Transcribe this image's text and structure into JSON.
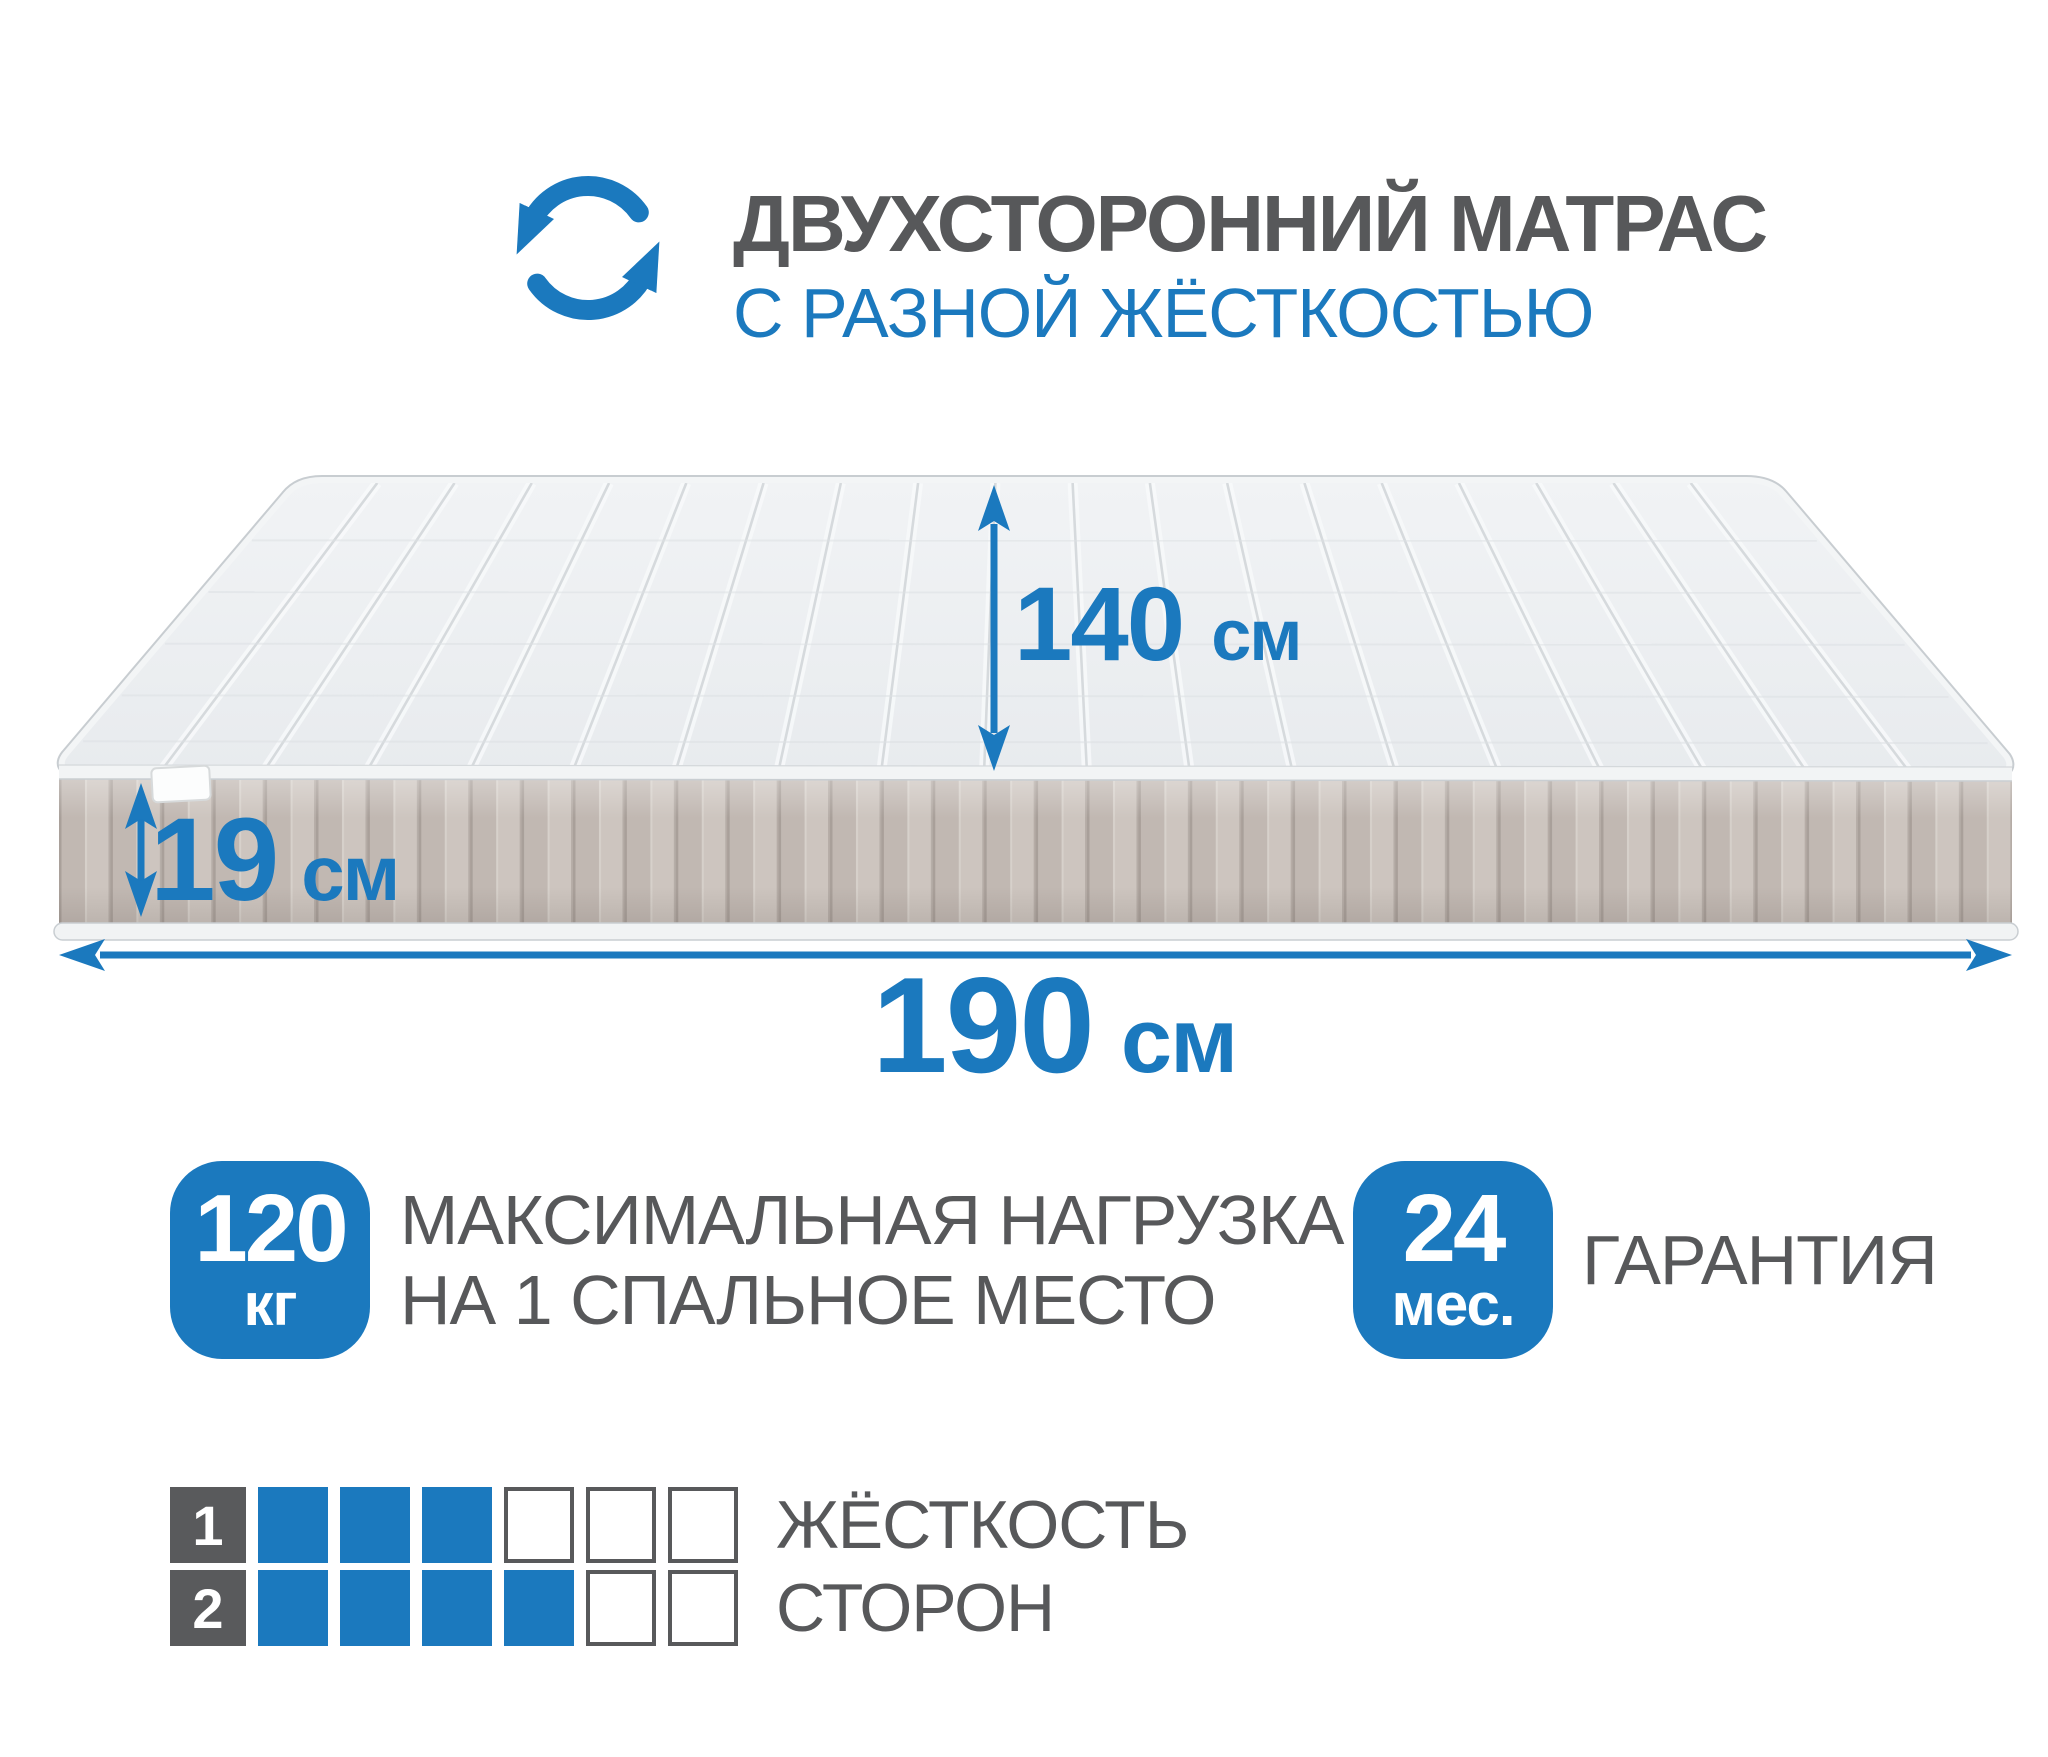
{
  "header": {
    "title": "ДВУХСТОРОННИЙ МАТРАС",
    "subtitle": "С РАЗНОЙ ЖЁСТКОСТЬЮ"
  },
  "dimensions": {
    "width": {
      "value": "140",
      "unit": "см"
    },
    "height": {
      "value": "19",
      "unit": "см"
    },
    "length": {
      "value": "190",
      "unit": "см"
    }
  },
  "badges": {
    "max_load": {
      "value": "120",
      "unit": "кг",
      "label_line1": "МАКСИМАЛЬНАЯ НАГРУЗКА",
      "label_line2": "НА 1 СПАЛЬНОЕ МЕСТО"
    },
    "warranty": {
      "value": "24",
      "unit": "мес.",
      "label": "ГАРАНТИЯ"
    }
  },
  "firmness_scale": {
    "label_line1": "ЖЁСТКОСТЬ",
    "label_line2": "СТОРОН",
    "max": 6,
    "sides": [
      {
        "side": "1",
        "value": 3
      },
      {
        "side": "2",
        "value": 4
      }
    ]
  },
  "colors": {
    "accent_blue": "#1b79be",
    "text_gray": "#57585a"
  }
}
